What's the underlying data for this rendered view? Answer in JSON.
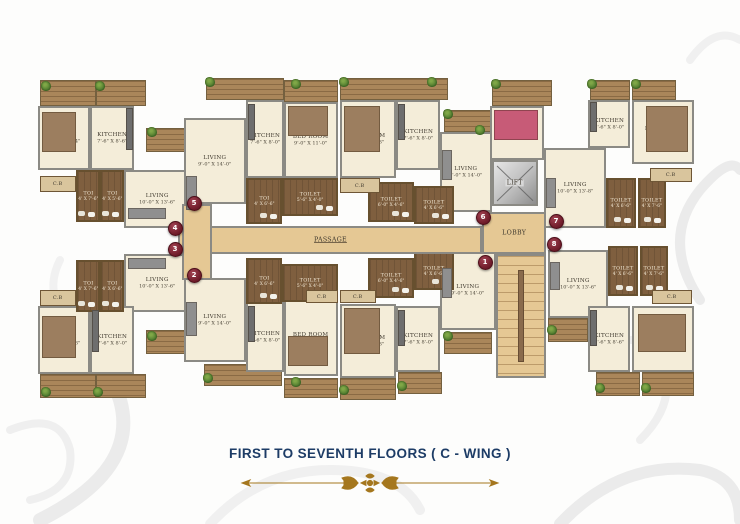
{
  "footer": {
    "caption": "FIRST TO SEVENTH FLOORS ( C - WING )"
  },
  "labels": {
    "passage": "PASSAGE",
    "lobby": "LOBBY",
    "lift": "LIFT",
    "cb": "C.B"
  },
  "palette": {
    "caption_navy": "#1d3c66",
    "ornament_gold": "#a5771e",
    "marker_maroon": "#6c1a28",
    "room_cream": "#f4edd9",
    "wood_brown": "#7f5f3f",
    "service_tan": "#e5c894"
  },
  "plan": {
    "rooms": [
      {
        "name": "BED RM",
        "dim": "9'-0\" X 11'-4\"",
        "x": 38,
        "y": 106,
        "w": 52,
        "h": 64
      },
      {
        "name": "KITCHEN",
        "dim": "7'-6\" X 8'-6\"",
        "x": 90,
        "y": 106,
        "w": 44,
        "h": 64
      },
      {
        "name": "LIVING",
        "dim": "10'-0\" X 13'-6\"",
        "x": 124,
        "y": 170,
        "w": 66,
        "h": 58
      },
      {
        "name": "LIVING",
        "dim": "9'-0\" X 14'-0\"",
        "x": 184,
        "y": 118,
        "w": 62,
        "h": 86
      },
      {
        "name": "KITCHEN",
        "dim": "7'-6\" X 8'-0\"",
        "x": 246,
        "y": 100,
        "w": 38,
        "h": 78
      },
      {
        "name": "BED ROOM",
        "dim": "9'-0\" X 11'-0\"",
        "x": 284,
        "y": 102,
        "w": 54,
        "h": 76
      },
      {
        "name": "BED ROOM",
        "dim": "9'-0\" X 11'-3\"",
        "x": 340,
        "y": 100,
        "w": 56,
        "h": 78
      },
      {
        "name": "KITCHEN",
        "dim": "7'-6\" X 8'-0\"",
        "x": 396,
        "y": 100,
        "w": 44,
        "h": 70
      },
      {
        "name": "LIVING",
        "dim": "9'-0\" X 14'-0\"",
        "x": 440,
        "y": 132,
        "w": 52,
        "h": 80
      },
      {
        "name": "BED ROOM",
        "dim": "7'-6\" X 10'-7\"",
        "x": 490,
        "y": 106,
        "w": 54,
        "h": 54
      },
      {
        "name": "LIVING",
        "dim": "10'-0\" X 13'-8\"",
        "x": 544,
        "y": 148,
        "w": 62,
        "h": 80
      },
      {
        "name": "KITCHEN",
        "dim": "7'-6\" X 8'-0\"",
        "x": 588,
        "y": 100,
        "w": 42,
        "h": 48
      },
      {
        "name": "BED ROOM",
        "dim": "9'-0\" X 11'-3\"",
        "x": 632,
        "y": 100,
        "w": 62,
        "h": 64
      },
      {
        "name": "LIVING",
        "dim": "10'-0\" X 13'-6\"",
        "x": 124,
        "y": 254,
        "w": 66,
        "h": 58
      },
      {
        "name": "BED RM",
        "dim": "9'-0\" X 11'-3\"",
        "x": 38,
        "y": 306,
        "w": 52,
        "h": 68
      },
      {
        "name": "KITCHEN",
        "dim": "7'-6\" X 8'-0\"",
        "x": 90,
        "y": 306,
        "w": 44,
        "h": 68
      },
      {
        "name": "LIVING",
        "dim": "9'-0\" X 14'-0\"",
        "x": 184,
        "y": 278,
        "w": 62,
        "h": 84
      },
      {
        "name": "KITCHEN",
        "dim": "7'-6\" X 8'-0\"",
        "x": 246,
        "y": 302,
        "w": 38,
        "h": 70
      },
      {
        "name": "BED ROOM",
        "dim": "9'-0\" X 11'-3\"",
        "x": 284,
        "y": 300,
        "w": 54,
        "h": 76
      },
      {
        "name": "BED ROOM",
        "dim": "9'-0\" X 11'-3\"",
        "x": 340,
        "y": 304,
        "w": 56,
        "h": 74
      },
      {
        "name": "KITCHEN",
        "dim": "7'-6\" X 8'-0\"",
        "x": 396,
        "y": 306,
        "w": 44,
        "h": 66
      },
      {
        "name": "LIVING",
        "dim": "9'-0\" X 14'-0\"",
        "x": 440,
        "y": 250,
        "w": 56,
        "h": 80
      },
      {
        "name": "LIVING",
        "dim": "10'-0\" X 13'-6\"",
        "x": 548,
        "y": 250,
        "w": 60,
        "h": 68
      },
      {
        "name": "KITCHEN",
        "dim": "7'-6\" X 8'-6\"",
        "x": 588,
        "y": 306,
        "w": 42,
        "h": 66
      },
      {
        "name": "BED RM",
        "dim": "9'-0\" X 11'-3\"",
        "x": 632,
        "y": 306,
        "w": 62,
        "h": 66
      }
    ],
    "toilets": [
      {
        "name": "TOI",
        "dim": "4' X 7'-6\"",
        "x": 76,
        "y": 170,
        "w": 24,
        "h": 52
      },
      {
        "name": "TOI",
        "dim": "4' X 5'-6\"",
        "x": 100,
        "y": 170,
        "w": 24,
        "h": 52
      },
      {
        "name": "TOI",
        "dim": "4' X 6'-6\"",
        "x": 246,
        "y": 178,
        "w": 36,
        "h": 46
      },
      {
        "name": "TOILET",
        "dim": "5'-6\" X 4'-0\"",
        "x": 282,
        "y": 178,
        "w": 56,
        "h": 38
      },
      {
        "name": "TOILET",
        "dim": "6'-0\" X 4'-6\"",
        "x": 368,
        "y": 182,
        "w": 46,
        "h": 40
      },
      {
        "name": "TOILET",
        "dim": "4' X 6'-6\"",
        "x": 414,
        "y": 186,
        "w": 40,
        "h": 38
      },
      {
        "name": "TOILET",
        "dim": "4' X 6'-6\"",
        "x": 606,
        "y": 178,
        "w": 30,
        "h": 50
      },
      {
        "name": "TOILET",
        "dim": "4' X 7'-6\"",
        "x": 638,
        "y": 178,
        "w": 28,
        "h": 50
      },
      {
        "name": "TOI",
        "dim": "4' X 7'-6\"",
        "x": 76,
        "y": 260,
        "w": 24,
        "h": 52
      },
      {
        "name": "TOI",
        "dim": "4' X 6'-6\"",
        "x": 100,
        "y": 260,
        "w": 24,
        "h": 52
      },
      {
        "name": "TOI",
        "dim": "4' X 6'-6\"",
        "x": 246,
        "y": 258,
        "w": 36,
        "h": 46
      },
      {
        "name": "TOILET",
        "dim": "5'-6\" X 4'-0\"",
        "x": 282,
        "y": 264,
        "w": 56,
        "h": 38
      },
      {
        "name": "TOILET",
        "dim": "6'-0\" X 4'-6\"",
        "x": 368,
        "y": 258,
        "w": 46,
        "h": 40
      },
      {
        "name": "TOILET",
        "dim": "4' X 6'-6\"",
        "x": 414,
        "y": 252,
        "w": 40,
        "h": 38
      },
      {
        "name": "TOILET",
        "dim": "4' X 6'-6\"",
        "x": 608,
        "y": 246,
        "w": 30,
        "h": 50
      },
      {
        "name": "TOILET",
        "dim": "4' X 7'-6\"",
        "x": 640,
        "y": 246,
        "w": 28,
        "h": 50
      }
    ],
    "cb_boxes": [
      {
        "x": 40,
        "y": 176,
        "w": 36,
        "h": 16
      },
      {
        "x": 340,
        "y": 178,
        "w": 40,
        "h": 15
      },
      {
        "x": 650,
        "y": 168,
        "w": 42,
        "h": 14
      },
      {
        "x": 40,
        "y": 290,
        "w": 36,
        "h": 16
      },
      {
        "x": 306,
        "y": 290,
        "w": 32,
        "h": 13
      },
      {
        "x": 340,
        "y": 290,
        "w": 36,
        "h": 13
      },
      {
        "x": 652,
        "y": 290,
        "w": 40,
        "h": 14
      }
    ],
    "balconies": [
      {
        "x": 40,
        "y": 80,
        "w": 56,
        "h": 26
      },
      {
        "x": 96,
        "y": 80,
        "w": 50,
        "h": 26
      },
      {
        "x": 146,
        "y": 128,
        "w": 60,
        "h": 24
      },
      {
        "x": 206,
        "y": 78,
        "w": 78,
        "h": 22
      },
      {
        "x": 284,
        "y": 80,
        "w": 54,
        "h": 22
      },
      {
        "x": 340,
        "y": 78,
        "w": 108,
        "h": 22
      },
      {
        "x": 444,
        "y": 110,
        "w": 48,
        "h": 22
      },
      {
        "x": 492,
        "y": 80,
        "w": 60,
        "h": 26
      },
      {
        "x": 590,
        "y": 80,
        "w": 40,
        "h": 20
      },
      {
        "x": 632,
        "y": 80,
        "w": 44,
        "h": 20
      },
      {
        "x": 40,
        "y": 374,
        "w": 56,
        "h": 24
      },
      {
        "x": 96,
        "y": 374,
        "w": 50,
        "h": 24
      },
      {
        "x": 146,
        "y": 330,
        "w": 60,
        "h": 24
      },
      {
        "x": 204,
        "y": 364,
        "w": 78,
        "h": 22
      },
      {
        "x": 284,
        "y": 378,
        "w": 54,
        "h": 20
      },
      {
        "x": 340,
        "y": 378,
        "w": 56,
        "h": 22
      },
      {
        "x": 398,
        "y": 372,
        "w": 44,
        "h": 22
      },
      {
        "x": 444,
        "y": 332,
        "w": 48,
        "h": 22
      },
      {
        "x": 548,
        "y": 318,
        "w": 40,
        "h": 24
      },
      {
        "x": 596,
        "y": 372,
        "w": 44,
        "h": 24
      },
      {
        "x": 642,
        "y": 372,
        "w": 52,
        "h": 24
      }
    ],
    "service": [
      {
        "kind": "passage",
        "x": 178,
        "y": 226,
        "w": 304,
        "h": 28
      },
      {
        "kind": "stub",
        "x": 182,
        "y": 204,
        "w": 30,
        "h": 76
      },
      {
        "kind": "lobby",
        "x": 482,
        "y": 212,
        "w": 64,
        "h": 42
      },
      {
        "kind": "stairs",
        "x": 496,
        "y": 254,
        "w": 50,
        "h": 124
      }
    ],
    "lift": {
      "x": 492,
      "y": 160,
      "w": 46,
      "h": 46
    },
    "markers": [
      {
        "n": "5",
        "x": 193,
        "y": 202
      },
      {
        "n": "4",
        "x": 174,
        "y": 227
      },
      {
        "n": "3",
        "x": 174,
        "y": 248
      },
      {
        "n": "2",
        "x": 193,
        "y": 274
      },
      {
        "n": "6",
        "x": 482,
        "y": 216
      },
      {
        "n": "7",
        "x": 555,
        "y": 220
      },
      {
        "n": "8",
        "x": 553,
        "y": 243
      },
      {
        "n": "1",
        "x": 484,
        "y": 261
      }
    ],
    "planters": [
      {
        "x": 46,
        "y": 86
      },
      {
        "x": 100,
        "y": 86
      },
      {
        "x": 152,
        "y": 132
      },
      {
        "x": 210,
        "y": 82
      },
      {
        "x": 296,
        "y": 84
      },
      {
        "x": 344,
        "y": 82
      },
      {
        "x": 432,
        "y": 82
      },
      {
        "x": 448,
        "y": 114
      },
      {
        "x": 480,
        "y": 130
      },
      {
        "x": 496,
        "y": 84
      },
      {
        "x": 592,
        "y": 84
      },
      {
        "x": 636,
        "y": 84
      },
      {
        "x": 46,
        "y": 392
      },
      {
        "x": 98,
        "y": 392
      },
      {
        "x": 152,
        "y": 336
      },
      {
        "x": 208,
        "y": 378
      },
      {
        "x": 296,
        "y": 382
      },
      {
        "x": 344,
        "y": 390
      },
      {
        "x": 402,
        "y": 386
      },
      {
        "x": 448,
        "y": 336
      },
      {
        "x": 552,
        "y": 330
      },
      {
        "x": 600,
        "y": 388
      },
      {
        "x": 646,
        "y": 388
      }
    ],
    "furniture": [
      {
        "x": 42,
        "y": 112,
        "w": 34,
        "h": 40,
        "c": "#9c7e5f"
      },
      {
        "x": 288,
        "y": 106,
        "w": 40,
        "h": 30,
        "c": "#9c7e5f"
      },
      {
        "x": 344,
        "y": 106,
        "w": 36,
        "h": 46,
        "c": "#9c7e5f"
      },
      {
        "x": 494,
        "y": 110,
        "w": 44,
        "h": 30,
        "c": "#c75b77"
      },
      {
        "x": 646,
        "y": 106,
        "w": 42,
        "h": 46,
        "c": "#9c7e5f"
      },
      {
        "x": 42,
        "y": 316,
        "w": 34,
        "h": 42,
        "c": "#9c7e5f"
      },
      {
        "x": 288,
        "y": 336,
        "w": 40,
        "h": 30,
        "c": "#9c7e5f"
      },
      {
        "x": 344,
        "y": 308,
        "w": 36,
        "h": 46,
        "c": "#9c7e5f"
      },
      {
        "x": 638,
        "y": 314,
        "w": 48,
        "h": 38,
        "c": "#9c7e5f"
      },
      {
        "x": 126,
        "y": 108,
        "w": 7,
        "h": 42,
        "c": "#6e6e6e"
      },
      {
        "x": 248,
        "y": 104,
        "w": 7,
        "h": 36,
        "c": "#6e6e6e"
      },
      {
        "x": 398,
        "y": 104,
        "w": 7,
        "h": 36,
        "c": "#6e6e6e"
      },
      {
        "x": 590,
        "y": 102,
        "w": 7,
        "h": 30,
        "c": "#6e6e6e"
      },
      {
        "x": 92,
        "y": 310,
        "w": 7,
        "h": 42,
        "c": "#6e6e6e"
      },
      {
        "x": 248,
        "y": 306,
        "w": 7,
        "h": 36,
        "c": "#6e6e6e"
      },
      {
        "x": 398,
        "y": 310,
        "w": 7,
        "h": 36,
        "c": "#6e6e6e"
      },
      {
        "x": 590,
        "y": 310,
        "w": 7,
        "h": 36,
        "c": "#6e6e6e"
      },
      {
        "x": 128,
        "y": 208,
        "w": 38,
        "h": 11,
        "c": "#8f8f8f"
      },
      {
        "x": 186,
        "y": 176,
        "w": 11,
        "h": 34,
        "c": "#8f8f8f"
      },
      {
        "x": 442,
        "y": 150,
        "w": 10,
        "h": 30,
        "c": "#8f8f8f"
      },
      {
        "x": 546,
        "y": 178,
        "w": 10,
        "h": 30,
        "c": "#8f8f8f"
      },
      {
        "x": 128,
        "y": 258,
        "w": 38,
        "h": 11,
        "c": "#8f8f8f"
      },
      {
        "x": 186,
        "y": 302,
        "w": 11,
        "h": 34,
        "c": "#8f8f8f"
      },
      {
        "x": 442,
        "y": 268,
        "w": 10,
        "h": 30,
        "c": "#8f8f8f"
      },
      {
        "x": 550,
        "y": 262,
        "w": 10,
        "h": 28,
        "c": "#8f8f8f"
      },
      {
        "x": 518,
        "y": 270,
        "w": 6,
        "h": 92,
        "c": "#8a6b4c"
      }
    ]
  }
}
